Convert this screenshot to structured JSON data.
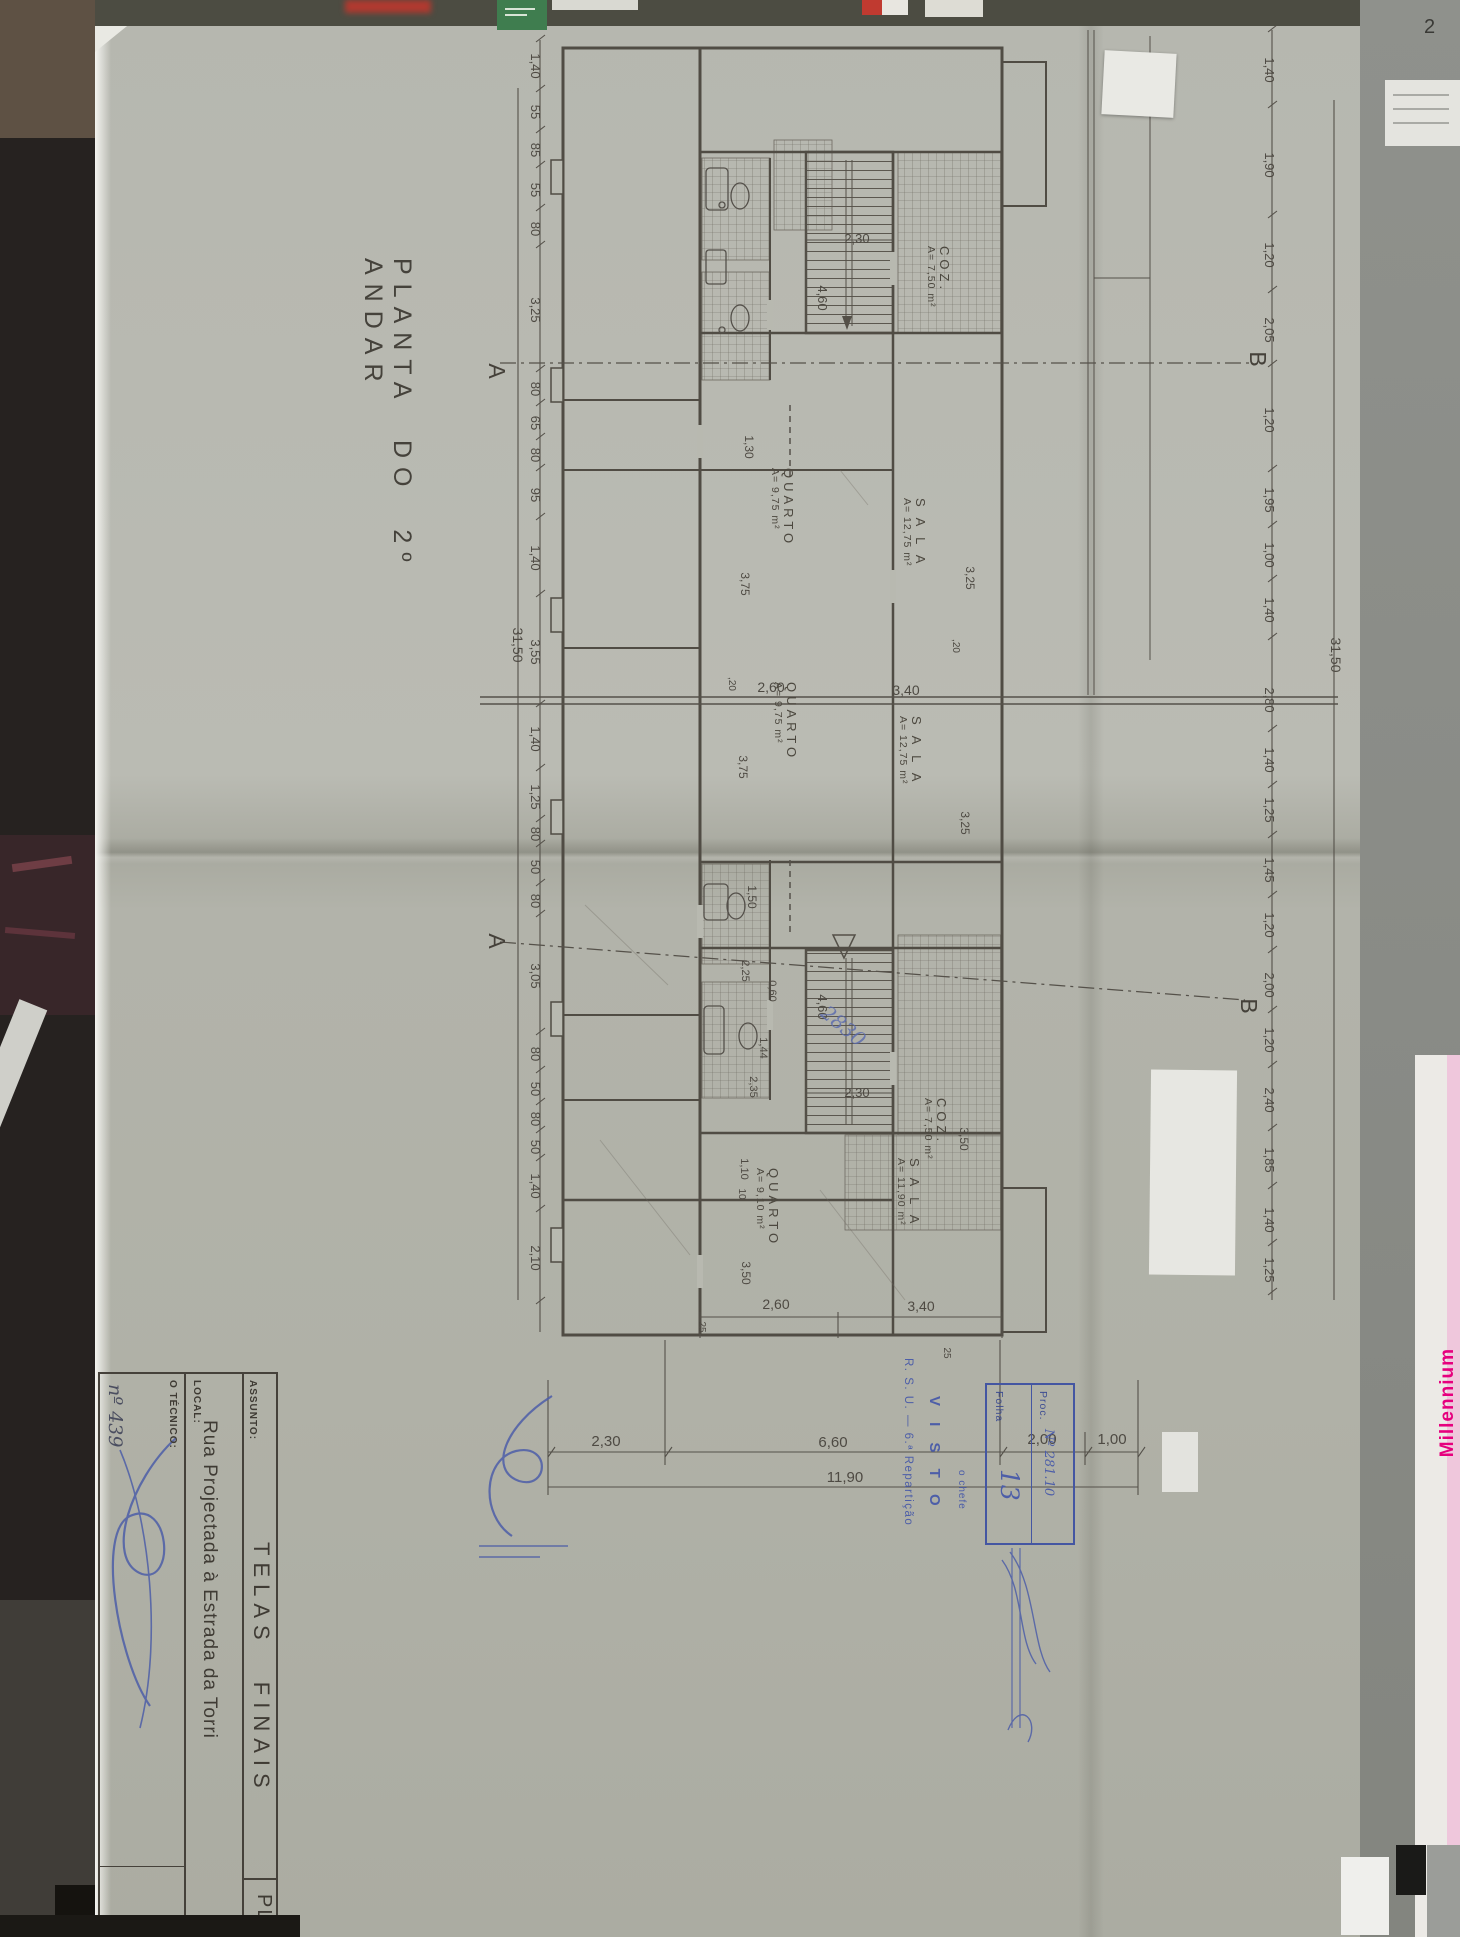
{
  "photo": {
    "corner_note": "2",
    "millennium": "Millennium"
  },
  "title": "PLANTA DO 2º ANDAR",
  "title_block": {
    "assunto_label": "ASSUNTO:",
    "assunto_value": "TELAS FINAIS",
    "local_label": "LOCAL:",
    "local_value": "Rua Projectada à Estrada da Torri",
    "tecnico_label": "O TÉCNICO:",
    "tecnico_no": "nº 439",
    "sheet_code": "PL"
  },
  "visto": {
    "dept": "R. S. U. — 6.ª Repartição",
    "word": "V I S T O",
    "chief": "o chefe"
  },
  "ref_box": {
    "folha_label": "Folha",
    "folha_value": "13",
    "proc_label": "Proc.",
    "proc_value": "Nº 281.10"
  },
  "note_blue": "2830",
  "markers": {
    "a": "A",
    "b": "B"
  },
  "rooms": [
    {
      "name": "QUARTO",
      "area": "A= 9,75 m²"
    },
    {
      "name": "S A L A",
      "area": "A= 12,75 m²"
    },
    {
      "name": "QUARTO",
      "area": "A= 9,75 m²"
    },
    {
      "name": "S A L A",
      "area": "A= 12,75 m²"
    },
    {
      "name": "COZ.",
      "area": "A= 7,50 m²"
    },
    {
      "name": "COZ.",
      "area": "A= 7,50 m²"
    },
    {
      "name": "QUARTO",
      "area": "A= 9,10 m²"
    },
    {
      "name": "S A L A",
      "area": "A= 11,90 m²"
    }
  ],
  "dims": {
    "left_chain": [
      "1,40",
      "55",
      "85",
      "55",
      "80",
      "3,25",
      "80",
      "65",
      "80",
      "95",
      "1,40",
      "3,55",
      "1,40",
      "1,25",
      "80",
      "50",
      "80",
      "3,05",
      "80",
      "50",
      "80",
      "50",
      "1,40",
      "2,10"
    ],
    "left_total": "31,50",
    "right_chain": [
      "1,40",
      "1,90",
      "1,20",
      "2,05",
      "1,20",
      "1,95",
      "1,00",
      "1,40",
      "2,80",
      "1,40",
      "1,25",
      "1,45",
      "1,20",
      "2,00",
      "1,20",
      "2,40",
      "1,85",
      "1,40",
      "1,25"
    ],
    "right_total": "31,50",
    "bottom_chain": [
      "2,30",
      "6,60",
      "2,00",
      "1,00"
    ],
    "bottom_total": "11,90",
    "room_upper": [
      "2,60",
      "3,40"
    ],
    "room_lower": [
      "2,60",
      "3,40"
    ],
    "stair_width": "2,30",
    "stair_well": "4,60",
    "quarto_depth": "3,75",
    "sala_depth": "3,25",
    "d130": "1,30",
    "d150": "1,50",
    "d225": "2,25",
    "d060": "0,60",
    "d144": "1,44",
    "d235": "2,35",
    "d110": "1,10",
    "d350": "3,50",
    "w20": ",20",
    "w25": "25",
    "w10": "10"
  }
}
